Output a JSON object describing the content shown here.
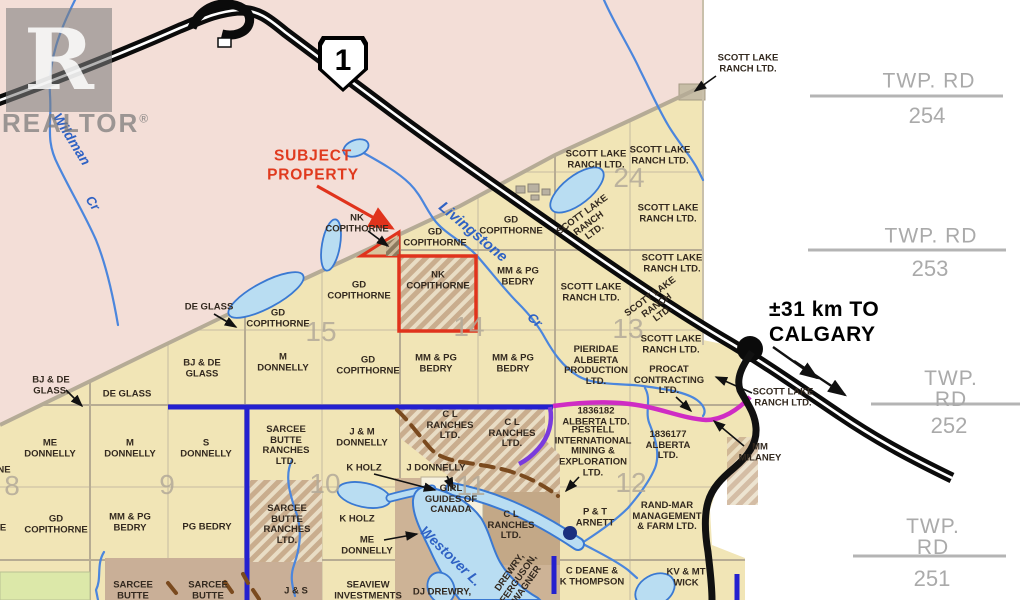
{
  "labels": {
    "scott_lake": "SCOTT LAKE\nRANCH LTD.",
    "scott_lake_3": "SCOTT LAKE\nRANCH\nLTD.",
    "gd_copithorne": "GD\nCOPITHORNE",
    "nk_copithorne": "NK\nCOPITHORNE",
    "mm_pg_bedry": "MM & PG\nBEDRY",
    "pg_bedry": "PG BEDRY",
    "de_glass": "DE GLASS",
    "bj_de_glass_dot": "BJ & DE\nGLASS.",
    "bj_de_glass": "BJ & DE\nGLASS",
    "me_donnelly": "ME\nDONNELLY",
    "m_donnelly": "M\nDONNELLY",
    "s_donnelly": "S\nDONNELLY",
    "jm_donnelly": "J & M\nDONNELLY",
    "j_donnelly": "J DONNELLY",
    "k_holz": "K HOLZ",
    "sarcee": "SARCEE\nBUTTE\nRANCHES\nLTD.",
    "sarcee_short": "SARCEE\nBUTTE",
    "girl_guides": "GIRL\nGUIDES OF\nCANADA",
    "cl_ranches": "C L\nRANCHES\nLTD.",
    "j_s": "J & S",
    "seaview": "SEAVIEW\nINVESTMENTS",
    "dj_drewry": "DJ DREWRY,",
    "drewry_rot": "DREWRY,\nFERGUSON,\nWAGNER",
    "c_deane": "C DEANE &\nK THOMPSON",
    "kv_wick": "KV & MT\nWICK",
    "rand_mar": "RAND-MAR\nMANAGEMENT\n& FARM LTD.",
    "pt_arnett": "P & T\nARNETT",
    "a1836182": "1836182\nALBERTA LTD.",
    "pestell": "PESTELL\nINTERNATIONAL\nMINING &\nEXPLORATION\nLTD.",
    "a1836177": "1836177\nALBERTA\nLTD.",
    "pieridae": "PIERIDAE\nALBERTA\nPRODUCTION\nLTD.",
    "procat": "PROCAT\nCONTRACTING\nLTD.",
    "mm_milaney": "MM\nMILANEY",
    "subject": "SUBJECT\nPROPERTY",
    "calgary": "±31 km TO\nCALGARY",
    "partial_ne": "NE",
    "partial_e": "E"
  },
  "sections": {
    "s8": "8",
    "s9": "9",
    "s10": "10",
    "s11": "11",
    "s12": "12",
    "s13": "13",
    "s14": "14",
    "s15": "15",
    "s24": "24"
  },
  "creeks": {
    "wildman": "Wildman",
    "wildman_cr": "Cr",
    "livingstone": "Livingstone",
    "livingstone_cr": "Cr",
    "westover": "Westover L."
  },
  "twp": [
    {
      "title": "TWP. RD",
      "number": "254"
    },
    {
      "title": "TWP. RD",
      "number": "253"
    },
    {
      "title": "TWP. RD",
      "number": "252"
    },
    {
      "title": "TWP. RD",
      "number": "251"
    }
  ],
  "highway": {
    "shield": "1"
  },
  "watermark": {
    "letter": "R",
    "word": "REALTOR",
    "reg": "®"
  },
  "colors": {
    "pink_region": "#f3ded7",
    "parcel_tan": "#f1e5b6",
    "brown_overlay": "#cdb396",
    "hatch_brown": "#c9ad8e",
    "green_parcel": "#dce8a9",
    "water_fill": "#b9ddf2",
    "water_line": "#3a79d2",
    "road_blue": "#2420cf",
    "road_magenta": "#cf2cc4",
    "road_violet": "#7a3bdd",
    "trail_brown": "#7a4a1e",
    "highway_black": "#0b0b0b",
    "subject_red": "#e0331c",
    "grey_text": "#aaaaaa"
  }
}
